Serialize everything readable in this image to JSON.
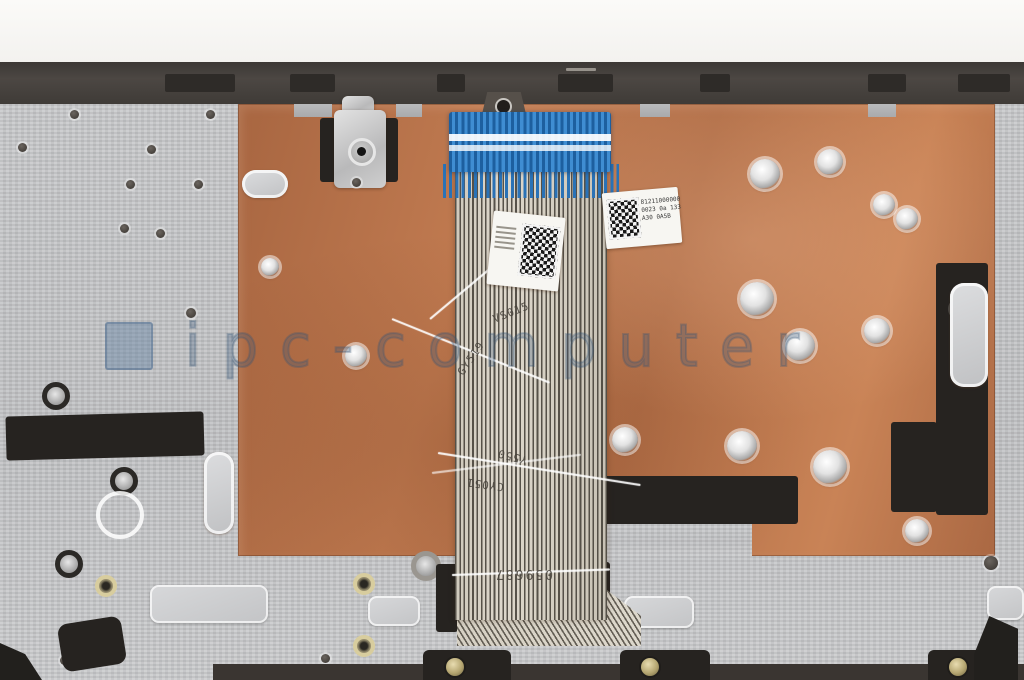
{
  "photo": {
    "subject": "laptop-palmrest-copper-shield-with-keyboard-ribbon-cable",
    "watermark": {
      "text": "ipc-computer"
    },
    "copper_label": {
      "line1": "81211000000",
      "line2": "0023 0a 133",
      "line3": "A30 0A5B"
    },
    "cable_markings": {
      "m1": "VS015",
      "m2": "GY519",
      "m3": "Y550",
      "m4": "CY051",
      "m5": "059687"
    },
    "colors": {
      "copper": "#b57048",
      "silver": "#c6c7c9",
      "bezel": "#48433f",
      "connector_blue": "#2e7fc2",
      "cable_beige": "#d9d3c7",
      "watermark_blue": "#3c5a7c"
    }
  }
}
